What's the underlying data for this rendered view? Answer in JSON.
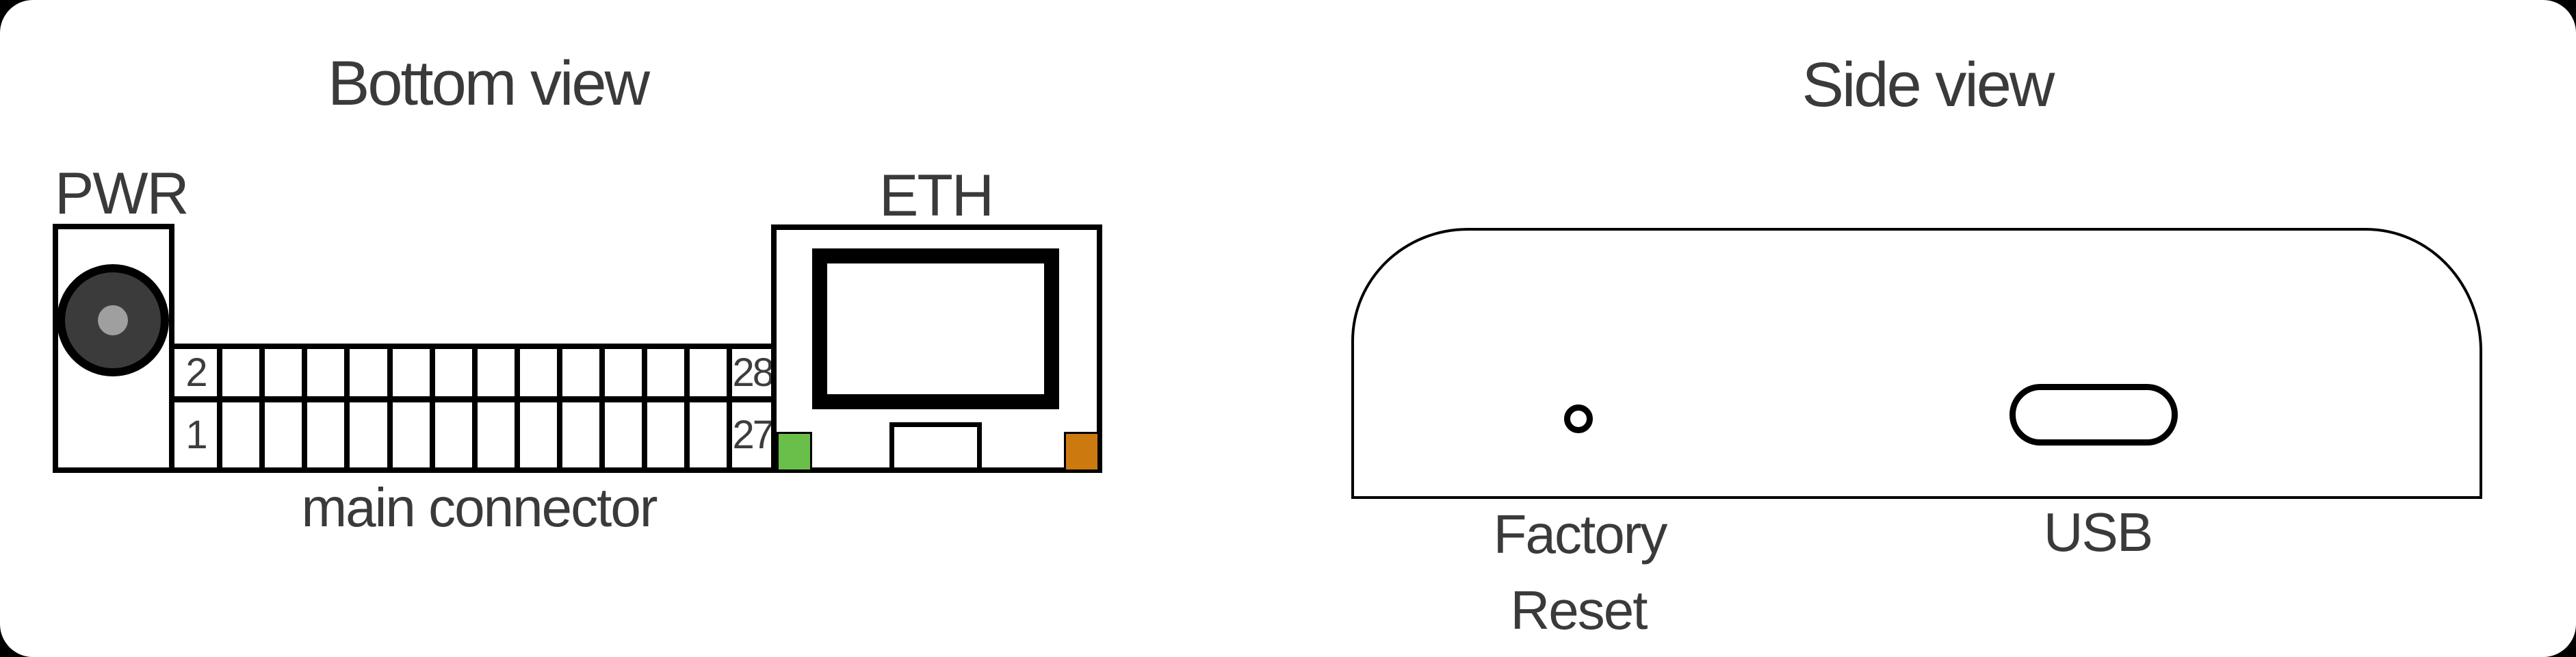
{
  "colors": {
    "background": "#000000",
    "card_background": "#ffffff",
    "line": "#000000",
    "text": "#3a3a3a",
    "jack_body": "#3b3b3b",
    "jack_pin": "#9f9f9f",
    "led_green": "#6abf4a",
    "led_amber": "#cc7a10"
  },
  "bottom_view": {
    "title": "Bottom view",
    "pwr": {
      "label": "PWR"
    },
    "connector": {
      "label": "main connector",
      "rows": 2,
      "columns": 14,
      "pin_labels": {
        "top_left": "2",
        "bottom_left": "1",
        "top_right": "28",
        "bottom_right": "27"
      }
    },
    "eth": {
      "label": "ETH"
    }
  },
  "side_view": {
    "title": "Side view",
    "factory_reset": {
      "label_line1": "Factory",
      "label_line2": "Reset"
    },
    "usb": {
      "label": "USB"
    }
  }
}
